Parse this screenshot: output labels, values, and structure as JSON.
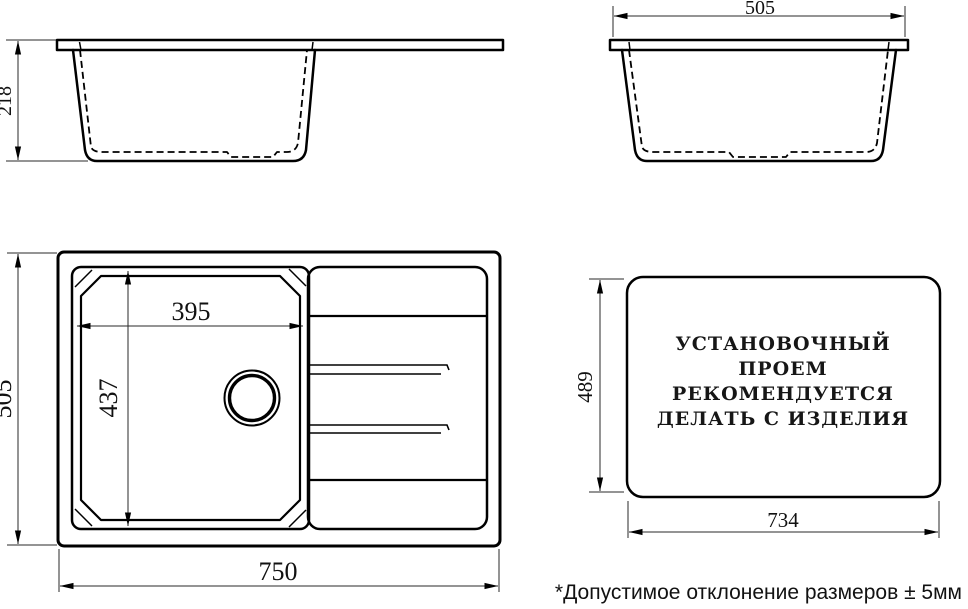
{
  "side_view": {
    "depth_label": "218"
  },
  "front_view": {
    "width_label": "505"
  },
  "plan_view": {
    "length_label": "750",
    "width_label": "505",
    "bowl_length_label": "395",
    "bowl_width_label": "437"
  },
  "cutout_view": {
    "height_label": "489",
    "width_label": "734",
    "note_line1": "УСТАНОВОЧНЫЙ",
    "note_line2": "ПРОЕМ",
    "note_line3": "РЕКОМЕНДУЕТСЯ",
    "note_line4": "ДЕЛАТЬ С ИЗДЕЛИЯ"
  },
  "footnote": "*Допустимое отклонение размеров ± 5мм",
  "colors": {
    "line": "#000000",
    "background": "#ffffff"
  }
}
